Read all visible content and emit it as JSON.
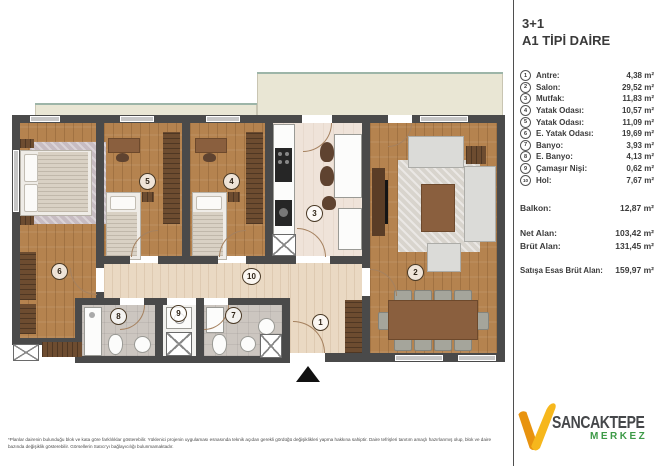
{
  "panel": {
    "title": "3+1",
    "subtitle": "A1 TİPİ DAİRE",
    "rooms": [
      {
        "num": "1",
        "label": "Antre:",
        "area": "4,38 m²"
      },
      {
        "num": "2",
        "label": "Salon:",
        "area": "29,52 m²"
      },
      {
        "num": "3",
        "label": "Mutfak:",
        "area": "11,83 m²"
      },
      {
        "num": "4",
        "label": "Yatak Odası:",
        "area": "10,57 m²"
      },
      {
        "num": "5",
        "label": "Yatak Odası:",
        "area": "11,09 m²"
      },
      {
        "num": "6",
        "label": "E. Yatak Odası:",
        "area": "19,69 m²"
      },
      {
        "num": "7",
        "label": "Banyo:",
        "area": "3,93 m²"
      },
      {
        "num": "8",
        "label": "E. Banyo:",
        "area": "4,13 m²"
      },
      {
        "num": "9",
        "label": "Çamaşır Nişi:",
        "area": "0,62 m²"
      },
      {
        "num": "10",
        "label": "Hol:",
        "area": "7,67 m²"
      }
    ],
    "balkon_label": "Balkon:",
    "balkon_value": "12,87 m²",
    "net_label": "Net Alan:",
    "net_value": "103,42 m²",
    "brut_label": "Brüt Alan:",
    "brut_value": "131,45 m²",
    "satis_label": "Satışa Esas Brüt Alan:",
    "satis_value": "159,97 m²"
  },
  "logo": {
    "name": "SANCAKTEPE",
    "sub": "MERKEZ"
  },
  "disclaimer": "*Planlar dairenin bulunduğu blok ve kata göre farklılıklar gösterebilir. Yüklenici projenin uygulaması esnasında teknik açıdan gerekli gördüğü değişiklikleri yapma hakkına sahiptir. Daire tefrişleri tanıtım amaçlı hazırlanmış olup, blok ve daire bazında değişiklik gösterebilir. Görsellerin Satıcı'yı bağlayıcılığı bulunmamaktadır.",
  "colors": {
    "brand_orange": "#F2A41F",
    "brand_green": "#3D9A47",
    "wall": "#4A4A4A",
    "wood_floor": "#B5834F",
    "balcony": "#E9E6D4"
  }
}
